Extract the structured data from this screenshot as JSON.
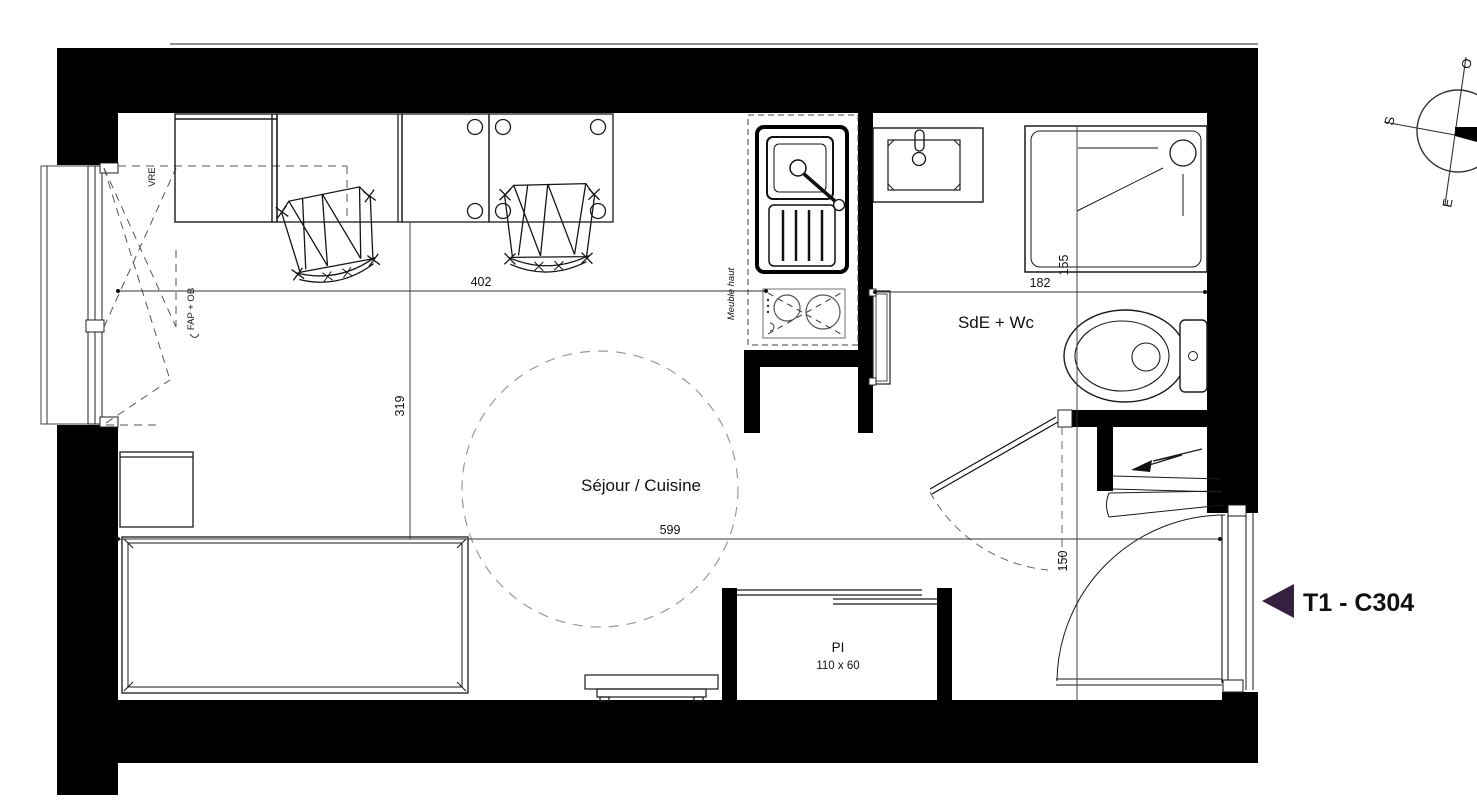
{
  "plan": {
    "unit": {
      "label": "T1 - C304"
    },
    "rooms": {
      "living": "Séjour / Cuisine",
      "bathroom": "SdE + Wc",
      "closet": "PI",
      "closet_size": "110 x 60"
    },
    "dims": {
      "living_width": "402",
      "desk_depth": "319",
      "living_length": "599",
      "bath_width": "182",
      "bath_depth": "155",
      "entry_clearance": "150"
    },
    "notes": {
      "window": "VRE",
      "vent": "FAP + OB",
      "wall_unit": "Meuble haut"
    },
    "compass": {
      "south": "S",
      "east": "E",
      "west": "O"
    },
    "colors": {
      "wall": "#000000",
      "accent": "#352040",
      "dash": "#777777"
    }
  }
}
